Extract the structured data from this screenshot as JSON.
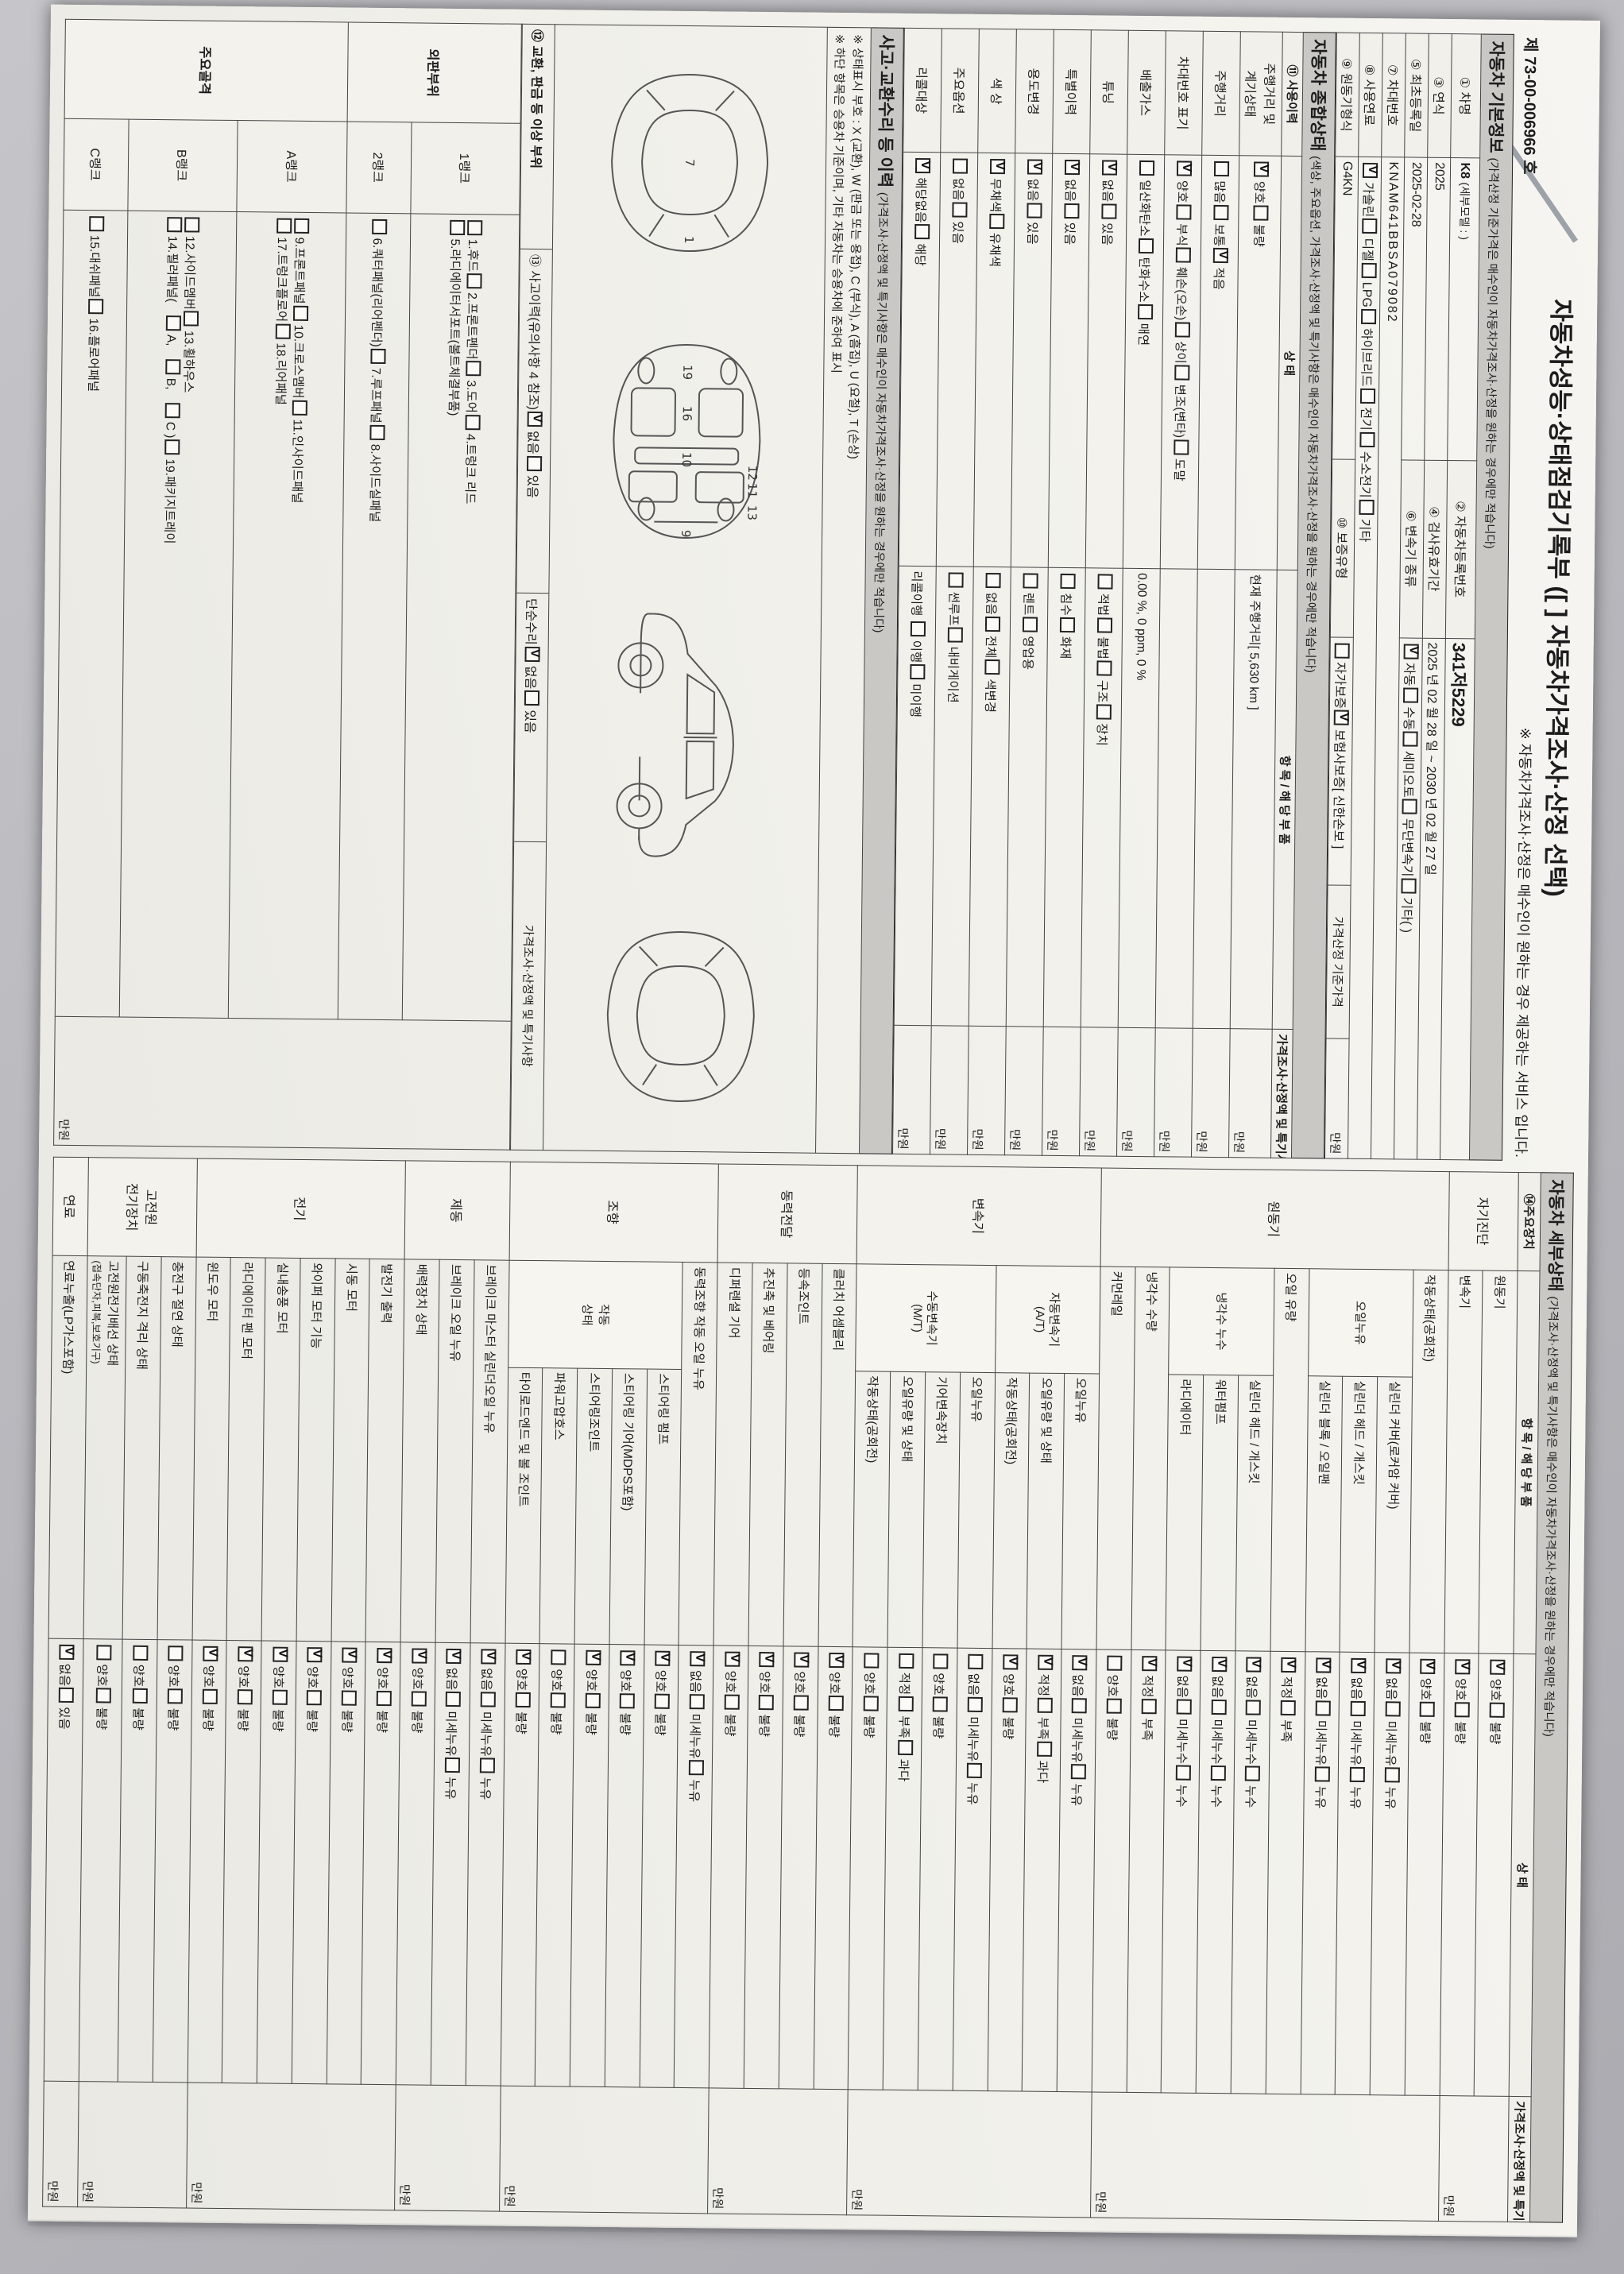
{
  "header": {
    "title_main": "자동차성능·상태점검기록부",
    "title_select": "([   ] 자동차가격조사·산정 선택)",
    "record_no_prefix": "제",
    "record_no": "73-00-006966",
    "record_no_suffix": "호",
    "service_note": "※ 자동차가격조사·산정은 매수인이 원하는 경우 제공하는 서비스 입니다."
  },
  "bands": {
    "basic": "자동차 기본정보",
    "basic_paren": "(가격산정 기준가격은 매수인이 자동차가격조사·산정을 원하는 경우에만 적습니다)",
    "comp": "자동차 종합상태",
    "comp_paren": "(색상, 주요옵션, 가격조사·산정액 및 특기사항은 매수인이 자동차가격조사·산정을 원하는 경우에만 적습니다)",
    "accident": "사고·교환수리 등 이력",
    "accident_paren": "(가격조사·산정액 및 특기사항은 매수인이 자동차가격조사·산정을 원하는 경우에만 적습니다)",
    "detail": "자동차 세부상태",
    "detail_paren": "(가격조사·산정액 및 특기사항은 매수인이 자동차가격조사·산정을 원하는 경우에만 적습니다)"
  },
  "basic": {
    "l1": "① 차명",
    "v1": "K8",
    "v1b": "(세부모델 :               )",
    "l2": "② 자동차등록번호",
    "v2": "341저5229",
    "l3": "③ 연식",
    "v3": "2025",
    "l4": "④ 검사유효기간",
    "v4": "2025 년 02 월 28 일   ~   2030 년 02 월 27 일",
    "l5": "⑤ 최초등록일",
    "v5": "2025-02-28",
    "l6": "⑥ 변속기 종류",
    "trans_opts": [
      [
        "자동",
        true
      ],
      [
        "수동",
        false
      ],
      [
        "세미오토",
        false
      ],
      [
        "무단변속기",
        false
      ],
      [
        "기타(          )",
        false
      ]
    ],
    "l7": "⑦ 차대번호",
    "v7": "KNAM641BBSA079082",
    "l8": "⑧ 사용연료",
    "fuel_opts": [
      [
        "가솔린",
        true
      ],
      [
        "디젤",
        false
      ],
      [
        "LPG",
        false
      ],
      [
        "하이브리드",
        false
      ],
      [
        "전기",
        false
      ],
      [
        "수소전기",
        false
      ],
      [
        "기타",
        false
      ]
    ],
    "l9": "⑨ 원동기형식",
    "v9": "G4KN",
    "l10": "⑩ 보증유형",
    "warranty_opts": [
      [
        "자가보증",
        false
      ],
      [
        "보험사보증",
        true
      ]
    ],
    "warranty_note": "[ 신한손보 ]",
    "price_base_label": "가격산정 기준가격",
    "price_unit": "만원"
  },
  "comp": {
    "headers": [
      "⑪ 사용이력",
      "상     태",
      "항 목 / 해 당 부 품",
      "가격조사·산정액 및 특기사항"
    ],
    "price_unit": "만원",
    "rows": [
      {
        "label": "주행거리 및\n계기상태",
        "opts": [
          [
            "양호",
            true
          ],
          [
            "불량",
            false
          ]
        ],
        "note": "현재 주행거리[   5,630 km   ]"
      },
      {
        "label": "주행거리",
        "opts": [
          [
            "많음",
            false
          ],
          [
            "보통",
            false
          ],
          [
            "적음",
            true
          ]
        ],
        "note": ""
      },
      {
        "label": "차대번호 표기",
        "opts": [
          [
            "양호",
            true
          ],
          [
            "부식",
            false
          ],
          [
            "훼손(오손)",
            false
          ],
          [
            "상이",
            false
          ],
          [
            "변조(변타)",
            false
          ],
          [
            "도말",
            false
          ]
        ],
        "note": ""
      },
      {
        "label": "배출가스",
        "opts": [
          [
            "일산화탄소",
            false
          ],
          [
            "탄화수소",
            false
          ],
          [
            "매연",
            false
          ]
        ],
        "note": "0.00 %,    0 ppm,    0 %"
      },
      {
        "label": "튜닝",
        "opts": [
          [
            "없음",
            true
          ],
          [
            "있음",
            false
          ]
        ],
        "opts2": [
          [
            "적법",
            false
          ],
          [
            "불법",
            false
          ],
          [
            "구조",
            false
          ],
          [
            "장치",
            false
          ]
        ]
      },
      {
        "label": "특별이력",
        "opts": [
          [
            "없음",
            true
          ],
          [
            "있음",
            false
          ]
        ],
        "opts2": [
          [
            "침수",
            false
          ],
          [
            "화재",
            false
          ]
        ]
      },
      {
        "label": "용도변경",
        "opts": [
          [
            "없음",
            true
          ],
          [
            "있음",
            false
          ]
        ],
        "opts2": [
          [
            "렌트",
            false
          ],
          [
            "영업용",
            false
          ]
        ]
      },
      {
        "label": "색  상",
        "opts": [
          [
            "무채색",
            true
          ],
          [
            "유채색",
            false
          ]
        ],
        "opts2": [
          [
            "없음",
            false
          ],
          [
            "전체",
            false
          ],
          [
            "색변경",
            false
          ]
        ]
      },
      {
        "label": "주요옵션",
        "opts": [
          [
            "없음",
            false
          ],
          [
            "있음",
            false
          ]
        ],
        "opts2": [
          [
            "썬루프",
            false
          ],
          [
            "내비게이션",
            false
          ]
        ]
      },
      {
        "label": "리콜대상",
        "opts": [
          [
            "해당없음",
            true
          ],
          [
            "해당",
            false
          ]
        ],
        "note_prefix": "리콜이행",
        "opts2": [
          [
            "이행",
            false
          ],
          [
            "미이행",
            false
          ]
        ]
      }
    ]
  },
  "accident": {
    "note1": "※ 상태표시 부호 : X (교환), W (판금 또는 용접), C (부식), A (흠집), U (요철), T (손상)",
    "note2": "※ 하단 항목은 승용차 기준이며, 기타 자동차는 승용차에 준하여 표시",
    "label12": "⑫ 교환, 판금 등 이상 부위",
    "label13": "⑬ 사고이력(유의사항 4 참조)",
    "accident_opts": [
      [
        "없음",
        true
      ],
      [
        "있음",
        false
      ]
    ],
    "simple_repair_label": "단순수리",
    "simple_repair_opts": [
      [
        "없음",
        true
      ],
      [
        "있음",
        false
      ]
    ],
    "price_header": "가격조사·산정액 및 특기사항",
    "price_unit": "만원",
    "diagrams": {
      "top_numbers": [
        "1",
        "7"
      ],
      "bottom_numbers": [
        "9",
        "10",
        "16",
        "19",
        "11",
        "12",
        "13"
      ]
    },
    "ranks": [
      {
        "group": "외판부위",
        "rank": "1랭크",
        "line1": [
          "1.후드",
          "2.프론트펜더",
          "3.도어",
          "4.트렁크 리드"
        ],
        "line2": [
          "5.라디에이터서포트(볼트체결부품)"
        ]
      },
      {
        "group": "외판부위",
        "rank": "2랭크",
        "line1": [
          "6.쿼터패널(리어펜더)",
          "7.루프패널",
          "8.사이드실패널"
        ],
        "line2": []
      },
      {
        "group": "주요골격",
        "rank": "A랭크",
        "line1": [
          "9.프론트패널",
          "10.크로스멤버",
          "11.인사이드패널"
        ],
        "line2": [
          "17.트렁크플로어",
          "18.리어패널"
        ]
      },
      {
        "group": "주요골격",
        "rank": "B랭크",
        "line1": [
          "12.사이드멤버",
          "13.휠하우스"
        ],
        "line2": [
          "14.필러패널( |A, |B, |C )",
          "19.패키지트레이"
        ]
      },
      {
        "group": "주요골격",
        "rank": "C랭크",
        "line1": [
          "15.대쉬패널",
          "16.플로어패널"
        ],
        "line2": []
      }
    ]
  },
  "detail": {
    "headers": [
      "⑭주요장치",
      "항 목 / 해 당 부 품",
      "상     태",
      "가격조사·산정액 및 특기사항"
    ],
    "price_unit": "만원",
    "groups": [
      {
        "name": "자기진단",
        "rows": [
          {
            "item": "원동기",
            "opts": [
              [
                "양호",
                true
              ],
              [
                "불량",
                false
              ]
            ]
          },
          {
            "item": "변속기",
            "opts": [
              [
                "양호",
                true
              ],
              [
                "불량",
                false
              ]
            ]
          }
        ]
      },
      {
        "name": "원동기",
        "rows": [
          {
            "item": "작동상태(공회전)",
            "opts": [
              [
                "양호",
                true
              ],
              [
                "불량",
                false
              ]
            ]
          },
          {
            "sub": "오일누유",
            "ss": 3,
            "item": "실린더 커버(로커암 커버)",
            "opts": [
              [
                "없음",
                true
              ],
              [
                "미세누유",
                false
              ],
              [
                "누유",
                false
              ]
            ]
          },
          {
            "item": "실린더 헤드 / 개스킷",
            "opts": [
              [
                "없음",
                true
              ],
              [
                "미세누유",
                false
              ],
              [
                "누유",
                false
              ]
            ]
          },
          {
            "item": "실린더 블록 / 오일팬",
            "opts": [
              [
                "없음",
                true
              ],
              [
                "미세누유",
                false
              ],
              [
                "누유",
                false
              ]
            ]
          },
          {
            "item": "오일 유량",
            "opts": [
              [
                "적정",
                true
              ],
              [
                "부족",
                false
              ]
            ]
          },
          {
            "sub": "냉각수 누수",
            "ss": 3,
            "item": "실린더 헤드 / 개스킷",
            "opts": [
              [
                "없음",
                true
              ],
              [
                "미세누수",
                false
              ],
              [
                "누수",
                false
              ]
            ]
          },
          {
            "item": "워터펌프",
            "opts": [
              [
                "없음",
                true
              ],
              [
                "미세누수",
                false
              ],
              [
                "누수",
                false
              ]
            ]
          },
          {
            "item": "라디에이터",
            "opts": [
              [
                "없음",
                true
              ],
              [
                "미세누수",
                false
              ],
              [
                "누수",
                false
              ]
            ]
          },
          {
            "item": "냉각수 수량",
            "opts": [
              [
                "적정",
                true
              ],
              [
                "부족",
                false
              ]
            ]
          },
          {
            "item": "커먼레일",
            "opts": [
              [
                "양호",
                false
              ],
              [
                "불량",
                false
              ]
            ]
          }
        ]
      },
      {
        "name": "변속기",
        "rows": [
          {
            "sub": "자동변속기\n(A/T)",
            "ss": 3,
            "item": "오일누유",
            "opts": [
              [
                "없음",
                true
              ],
              [
                "미세누유",
                false
              ],
              [
                "누유",
                false
              ]
            ]
          },
          {
            "item": "오일유량 및 상태",
            "opts": [
              [
                "적정",
                true
              ],
              [
                "부족",
                false
              ],
              [
                "과다",
                false
              ]
            ]
          },
          {
            "item": "작동상태(공회전)",
            "opts": [
              [
                "양호",
                true
              ],
              [
                "불량",
                false
              ]
            ]
          },
          {
            "sub": "수동변속기\n(M/T)",
            "ss": 4,
            "item": "오일누유",
            "opts": [
              [
                "없음",
                false
              ],
              [
                "미세누유",
                false
              ],
              [
                "누유",
                false
              ]
            ]
          },
          {
            "item": "기어변속장치",
            "opts": [
              [
                "양호",
                false
              ],
              [
                "불량",
                false
              ]
            ]
          },
          {
            "item": "오일유량 및 상태",
            "opts": [
              [
                "적정",
                false
              ],
              [
                "부족",
                false
              ],
              [
                "과다",
                false
              ]
            ]
          },
          {
            "item": "작동상태(공회전)",
            "opts": [
              [
                "양호",
                false
              ],
              [
                "불량",
                false
              ]
            ]
          }
        ]
      },
      {
        "name": "동력전달",
        "rows": [
          {
            "item": "클러치 어셈블리",
            "opts": [
              [
                "양호",
                true
              ],
              [
                "불량",
                false
              ]
            ]
          },
          {
            "item": "등속조인트",
            "opts": [
              [
                "양호",
                true
              ],
              [
                "불량",
                false
              ]
            ]
          },
          {
            "item": "추진축 및 베어링",
            "opts": [
              [
                "양호",
                true
              ],
              [
                "불량",
                false
              ]
            ]
          },
          {
            "item": "디퍼렌셜 기어",
            "opts": [
              [
                "양호",
                true
              ],
              [
                "불량",
                false
              ]
            ]
          }
        ]
      },
      {
        "name": "조향",
        "rows": [
          {
            "item": "동력조향 작동 오일 누유",
            "opts": [
              [
                "없음",
                true
              ],
              [
                "미세누유",
                false
              ],
              [
                "누유",
                false
              ]
            ]
          },
          {
            "sub": "작동\n상태",
            "ss": 5,
            "item": "스티어링 펌프",
            "opts": [
              [
                "양호",
                true
              ],
              [
                "불량",
                false
              ]
            ]
          },
          {
            "item": "스티어링 기어(MDPS포함)",
            "opts": [
              [
                "양호",
                true
              ],
              [
                "불량",
                false
              ]
            ]
          },
          {
            "item": "스티어링조인트",
            "opts": [
              [
                "양호",
                true
              ],
              [
                "불량",
                false
              ]
            ]
          },
          {
            "item": "파워고압호스",
            "opts": [
              [
                "양호",
                false
              ],
              [
                "불량",
                false
              ]
            ]
          },
          {
            "item": "타이로드엔드 및 볼 조인트",
            "opts": [
              [
                "양호",
                true
              ],
              [
                "불량",
                false
              ]
            ]
          }
        ]
      },
      {
        "name": "제동",
        "rows": [
          {
            "item": "브레이크 마스터 실린더오일 누유",
            "opts": [
              [
                "없음",
                true
              ],
              [
                "미세누유",
                false
              ],
              [
                "누유",
                false
              ]
            ]
          },
          {
            "item": "브레이크 오일 누유",
            "opts": [
              [
                "없음",
                true
              ],
              [
                "미세누유",
                false
              ],
              [
                "누유",
                false
              ]
            ]
          },
          {
            "item": "배력장치 상태",
            "opts": [
              [
                "양호",
                true
              ],
              [
                "불량",
                false
              ]
            ]
          }
        ]
      },
      {
        "name": "전기",
        "rows": [
          {
            "item": "발전기 출력",
            "opts": [
              [
                "양호",
                true
              ],
              [
                "불량",
                false
              ]
            ]
          },
          {
            "item": "시동 모터",
            "opts": [
              [
                "양호",
                true
              ],
              [
                "불량",
                false
              ]
            ]
          },
          {
            "item": "와이퍼 모터 기능",
            "opts": [
              [
                "양호",
                true
              ],
              [
                "불량",
                false
              ]
            ]
          },
          {
            "item": "실내송풍 모터",
            "opts": [
              [
                "양호",
                true
              ],
              [
                "불량",
                false
              ]
            ]
          },
          {
            "item": "라디에이터 팬 모터",
            "opts": [
              [
                "양호",
                true
              ],
              [
                "불량",
                false
              ]
            ]
          },
          {
            "item": "윈도우 모터",
            "opts": [
              [
                "양호",
                true
              ],
              [
                "불량",
                false
              ]
            ]
          }
        ]
      },
      {
        "name": "고전원\n전기장치",
        "rows": [
          {
            "item": "충전구 절연 상태",
            "opts": [
              [
                "양호",
                false
              ],
              [
                "불량",
                false
              ]
            ]
          },
          {
            "item": "구동축전지 격리 상태",
            "opts": [
              [
                "양호",
                false
              ],
              [
                "불량",
                false
              ]
            ]
          },
          {
            "item": "고전원전기배선 상태",
            "item2": "(접속단자,피복,보호기구)",
            "opts": [
              [
                "양호",
                false
              ],
              [
                "불량",
                false
              ]
            ]
          }
        ]
      },
      {
        "name": "연료",
        "rows": [
          {
            "item": "연료누출(LP가스포함)",
            "opts": [
              [
                "없음",
                true
              ],
              [
                "있음",
                false
              ]
            ]
          }
        ]
      }
    ]
  }
}
